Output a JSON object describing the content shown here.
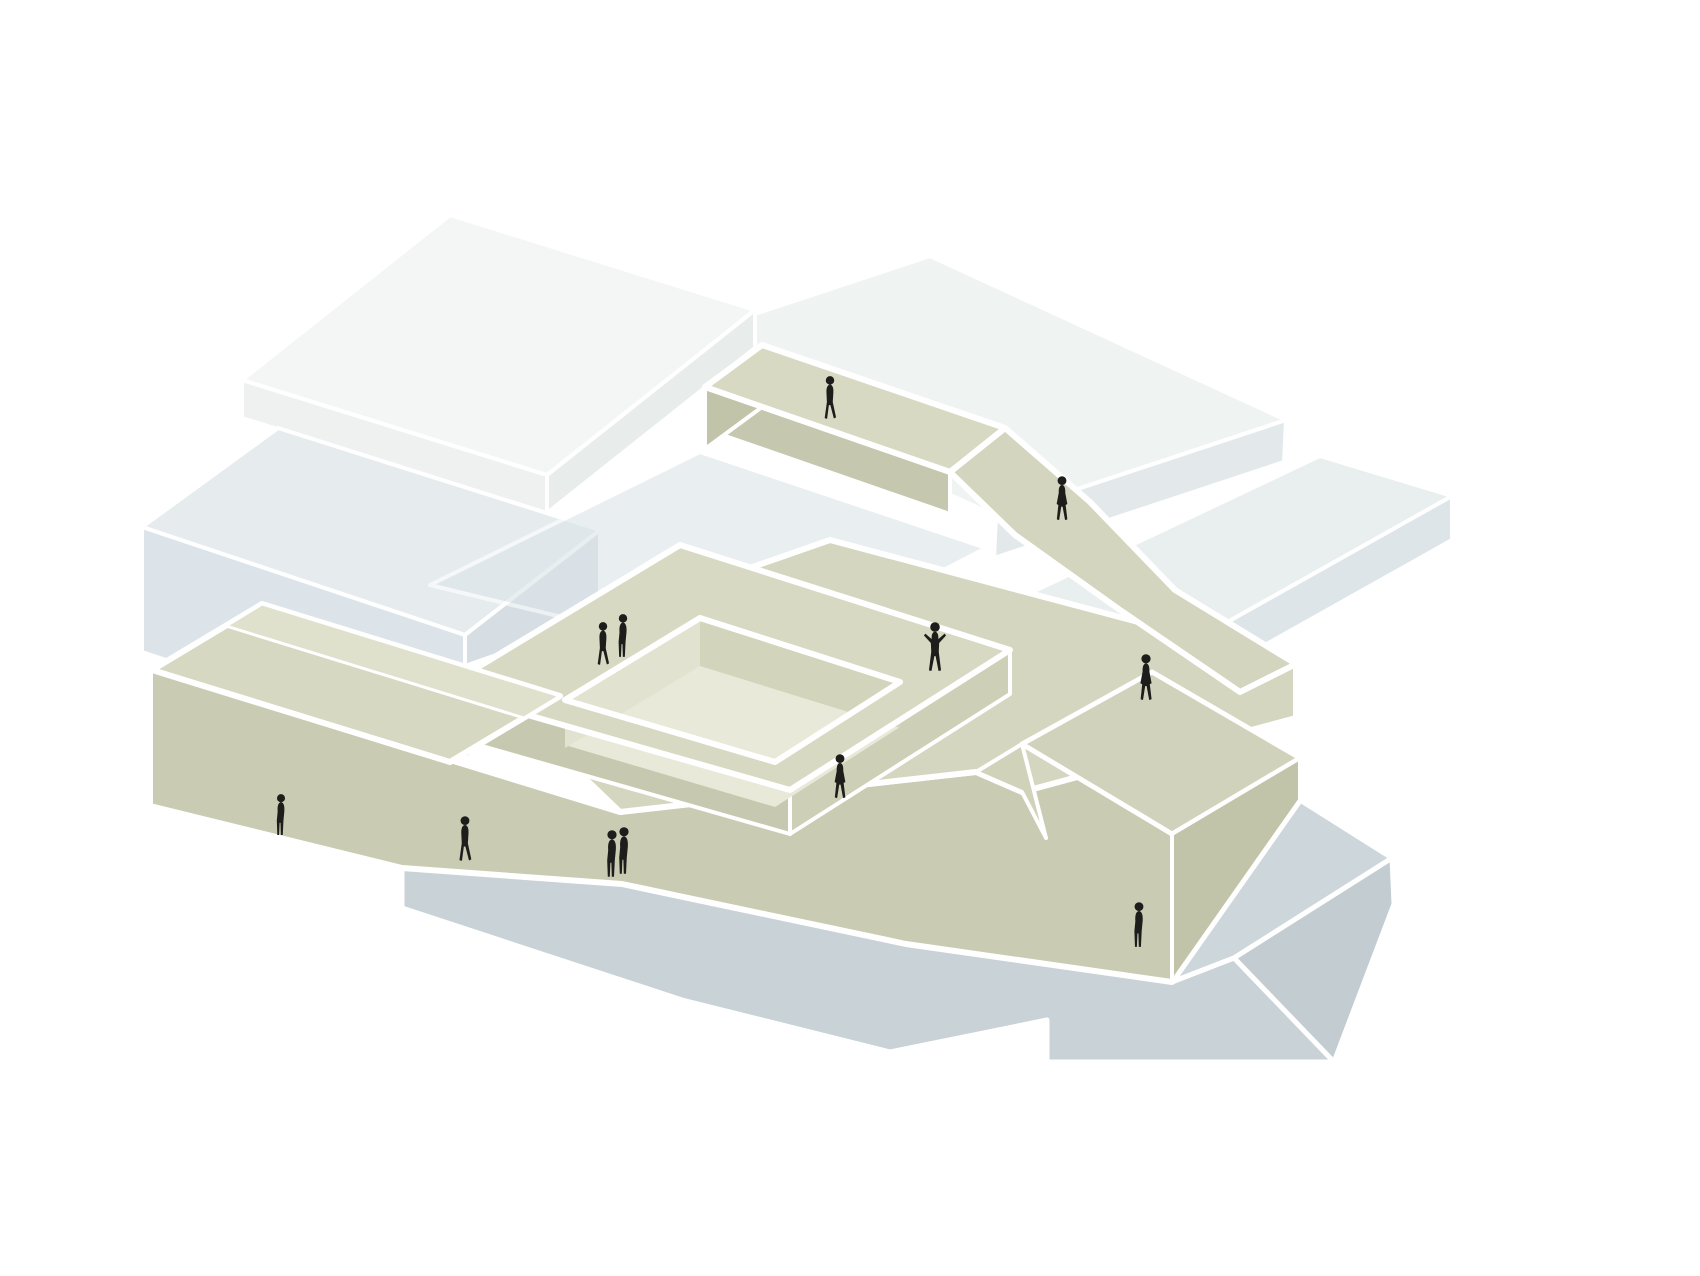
{
  "meta": {
    "type": "architectural-axonometric-diagram",
    "canvas": {
      "width": 1700,
      "height": 1276
    },
    "background": "#ffffff",
    "description": "Axonometric diagram of stacked building slabs with a beige public ramp, bridge and courtyard walkway loop threading between white and blue-gray volumes over a gray base plinth, populated by small black human silhouettes"
  },
  "palette": {
    "background": "#ffffff",
    "outline": "#ffffff",
    "figure": "#1d1d1b",
    "white_slab": "#f4f6f5",
    "pale_slab": "#eff3f2",
    "bluegray_slab": "#e6ecee",
    "gray_slab": "#e9eeef",
    "base_gray": "#c9d2d7",
    "beige_top": "#d7d9c3",
    "beige_front": "#c9cbb2",
    "beige_dark": "#c2c4aa",
    "beige_inner": "#e1e2d0"
  },
  "shapes": [
    {
      "name": "back-right-slab-top",
      "fill": "#eff3f2",
      "sw": 4,
      "points": "640,352 930,256 1286,420 996,516"
    },
    {
      "name": "back-right-slab-front",
      "fill": "#e3e9ea",
      "sw": 4,
      "points": "996,516 1286,420 1284,462 994,558"
    },
    {
      "name": "roof-slab-top",
      "fill": "#f4f6f5",
      "sw": 4,
      "points": "242,380 450,215 755,310 547,475"
    },
    {
      "name": "roof-slab-right",
      "fill": "#e8edec",
      "sw": 4,
      "points": "547,475 755,310 755,348 547,513"
    },
    {
      "name": "roof-slab-front",
      "fill": "#eef1f0",
      "sw": 4,
      "points": "242,380 547,475 547,513 242,418"
    },
    {
      "name": "west-volume-top",
      "fill": "#e6ecee",
      "sw": 4,
      "points": "142,527 278,428 600,530 465,635"
    },
    {
      "name": "west-volume-right",
      "fill": "#d6dee3",
      "sw": 4,
      "points": "465,635 600,530 600,655 465,760"
    },
    {
      "name": "west-volume-front",
      "fill": "#dde4e9",
      "sw": 4,
      "points": "142,527 465,635 465,760 142,652"
    },
    {
      "name": "underpass-walkway",
      "fill": "#dce4e8",
      "sw": 4,
      "opacity": 0.6,
      "points": "430,585 700,452 986,548 760,665"
    },
    {
      "name": "east-slab-top",
      "fill": "#e9eeef",
      "sw": 4,
      "points": "952,630 1320,456 1452,496 1085,702"
    },
    {
      "name": "east-slab-front",
      "fill": "#dee5e9",
      "sw": 4,
      "points": "1085,702 1452,496 1452,540 1085,746"
    },
    {
      "name": "base-plinth-top",
      "fill": "#cdd6da",
      "sw": 5,
      "points": "1172,982 1300,800 1392,858 1234,958"
    },
    {
      "name": "base-plinth-step",
      "fill": "#c2ccd1",
      "sw": 5,
      "points": "1234,958 1392,858 1394,904 1334,1062"
    },
    {
      "name": "base-plinth-front",
      "fill": "#c9d2d7",
      "sw": 5,
      "points": "402,868 622,884 906,944 1172,982 1234,958 1334,1062 1047,1062 1047,1020 890,1052 682,1000 402,908"
    },
    {
      "name": "ramp-building-front-wall",
      "fill": "#c9cbb2",
      "sw": 6,
      "points": "150,668 620,812 706,802 976,772 1022,744 1152,672 1300,758 1300,800 1172,982 906,944 622,884 402,868 150,806"
    },
    {
      "name": "plaza-deck",
      "fill": "#d4d6c0",
      "sw": 6,
      "points": "620,812 468,666 830,540 1296,664 1296,718 1022,792 976,772"
    },
    {
      "name": "courtyard-loop-side-sw",
      "fill": "#c6c8af",
      "sw": 4,
      "points": "440,690 790,790 790,834 440,734"
    },
    {
      "name": "courtyard-loop-side-se",
      "fill": "#cdcfb6",
      "sw": 4,
      "points": "790,790 1010,650 1010,694 790,834"
    },
    {
      "name": "courtyard-floor",
      "fill": "#e8e9d8",
      "sw": 0,
      "points": "565,745 700,663 900,727 775,807"
    },
    {
      "name": "courtyard-wall-nw",
      "fill": "#e1e2d0",
      "sw": 0,
      "points": "565,700 700,618 700,666 565,748"
    },
    {
      "name": "courtyard-wall-ne",
      "fill": "#d2d4bc",
      "sw": 0,
      "points": "700,618 900,682 900,728 700,666"
    },
    {
      "name": "courtyard-loop-walkway",
      "fill": "#d7d9c3",
      "sw": 6,
      "points": "440,690 680,545 1010,650 790,790",
      "hole": "565,700 700,618 900,682 775,762"
    },
    {
      "name": "east-block-top",
      "fill": "#d0d2bb",
      "sw": 5,
      "points": "1022,744 1152,672 1300,758 1172,834"
    },
    {
      "name": "east-block-right",
      "fill": "#c2c4aa",
      "sw": 4,
      "points": "1172,834 1300,758 1300,800 1172,982"
    },
    {
      "name": "east-block-swoop",
      "fill": "#d0d2ba",
      "sw": 4,
      "points": "976,772 1022,744 1046,838 1022,792"
    },
    {
      "name": "descending-ramp",
      "fill": "#d3d5bf",
      "sw": 6,
      "points": "950,472 1005,428 1090,502 1175,590 1296,664 1240,692 1120,610 1015,535"
    },
    {
      "name": "bridge-side",
      "fill": "#c5c7ae",
      "sw": 4,
      "points": "705,387 950,472 950,514 705,429"
    },
    {
      "name": "bridge-end-cap",
      "fill": "#c2c4aa",
      "sw": 4,
      "points": "705,387 762,345 762,407 705,449"
    },
    {
      "name": "bridge-deck",
      "fill": "#d7d9c3",
      "sw": 6,
      "points": "705,387 762,345 1005,428 950,472"
    },
    {
      "name": "west-terrace-roof",
      "fill": "#d6d8c2",
      "sw": 6,
      "points": "152,670 262,604 560,696 450,762"
    },
    {
      "name": "west-terrace-parapet",
      "fill": "#dfe1cd",
      "sw": 3,
      "points": "262,604 560,696 524,718 226,626"
    }
  ],
  "people": [
    {
      "name": "person-bridge-walker",
      "pose": "walk",
      "x": 830,
      "y": 420,
      "h": 44
    },
    {
      "name": "person-ramp-walker",
      "pose": "skirt",
      "x": 1062,
      "y": 522,
      "h": 46
    },
    {
      "name": "person-courtyard-walker",
      "pose": "walk",
      "x": 603,
      "y": 666,
      "h": 44
    },
    {
      "name": "person-courtyard-stander",
      "pose": "stand",
      "x": 623,
      "y": 658,
      "h": 44
    },
    {
      "name": "person-plaza-greeter",
      "pose": "arms",
      "x": 935,
      "y": 672,
      "h": 50
    },
    {
      "name": "person-east-walkway-walker",
      "pose": "skirt",
      "x": 1146,
      "y": 702,
      "h": 48
    },
    {
      "name": "person-west-promenade",
      "pose": "stand",
      "x": 281,
      "y": 836,
      "h": 42
    },
    {
      "name": "person-south-promenade",
      "pose": "walk",
      "x": 465,
      "y": 862,
      "h": 46
    },
    {
      "name": "person-couple-a",
      "pose": "stand",
      "x": 612,
      "y": 878,
      "h": 48
    },
    {
      "name": "person-couple-b",
      "pose": "stand",
      "x": 624,
      "y": 875,
      "h": 48
    },
    {
      "name": "person-plaza-edge-walker",
      "pose": "skirt",
      "x": 840,
      "y": 800,
      "h": 46
    },
    {
      "name": "person-southeast-stander",
      "pose": "stand",
      "x": 1139,
      "y": 948,
      "h": 46
    }
  ]
}
